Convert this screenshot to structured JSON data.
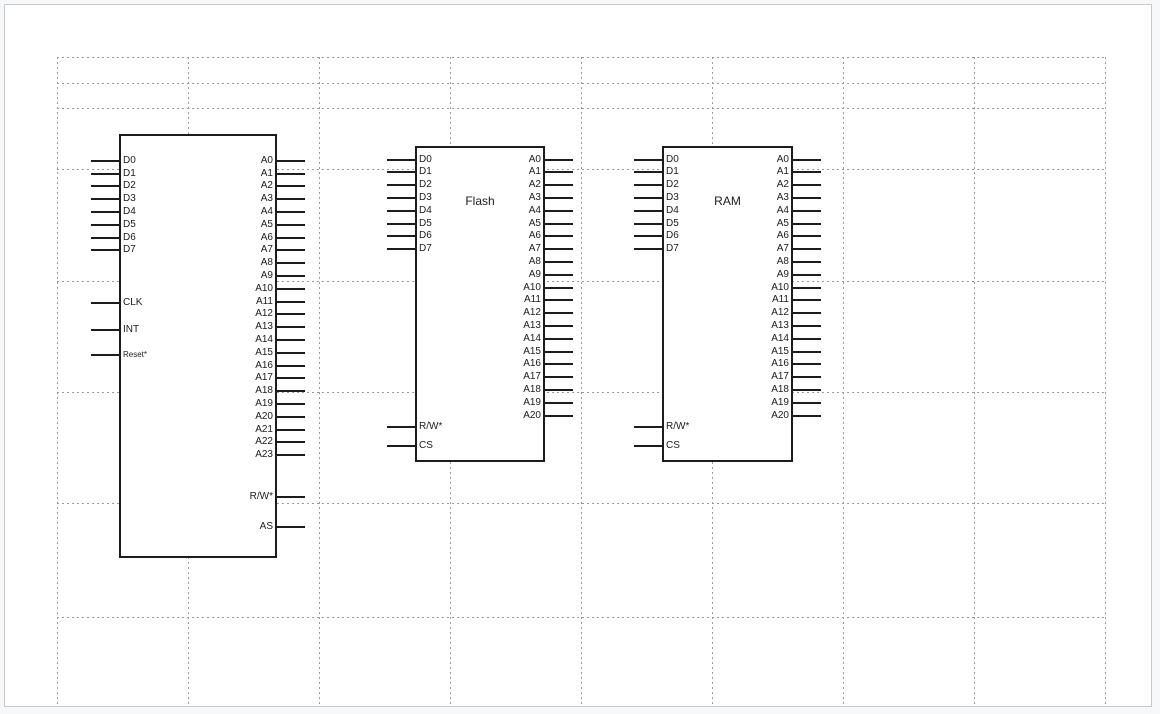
{
  "canvas": {
    "background": "#ffffff",
    "page_border_color": "#c9c9c9",
    "grid_color": "#9b9b9b",
    "line_color": "#1c1c1c"
  },
  "chips": [
    {
      "id": "cpu",
      "title": "",
      "left_pins": [
        {
          "label": "D0",
          "slot": 0
        },
        {
          "label": "D1",
          "slot": 1
        },
        {
          "label": "D2",
          "slot": 2
        },
        {
          "label": "D3",
          "slot": 3
        },
        {
          "label": "D4",
          "slot": 4
        },
        {
          "label": "D5",
          "slot": 5
        },
        {
          "label": "D6",
          "slot": 6
        },
        {
          "label": "D7",
          "slot": 7
        },
        {
          "label": "CLK",
          "slot": 11.15
        },
        {
          "label": "INT",
          "slot": 13.2
        },
        {
          "label": "Reset*",
          "slot": 15.2,
          "small": true
        }
      ],
      "right_pins": [
        {
          "label": "A0",
          "slot": 0
        },
        {
          "label": "A1",
          "slot": 1
        },
        {
          "label": "A2",
          "slot": 2
        },
        {
          "label": "A3",
          "slot": 3
        },
        {
          "label": "A4",
          "slot": 4
        },
        {
          "label": "A5",
          "slot": 5
        },
        {
          "label": "A6",
          "slot": 6
        },
        {
          "label": "A7",
          "slot": 7
        },
        {
          "label": "A8",
          "slot": 8
        },
        {
          "label": "A9",
          "slot": 9
        },
        {
          "label": "A10",
          "slot": 10
        },
        {
          "label": "A11",
          "slot": 11
        },
        {
          "label": "A12",
          "slot": 12
        },
        {
          "label": "A13",
          "slot": 13
        },
        {
          "label": "A14",
          "slot": 14
        },
        {
          "label": "A15",
          "slot": 15
        },
        {
          "label": "A16",
          "slot": 16
        },
        {
          "label": "A17",
          "slot": 17
        },
        {
          "label": "A18",
          "slot": 18
        },
        {
          "label": "A19",
          "slot": 19
        },
        {
          "label": "A20",
          "slot": 20
        },
        {
          "label": "A21",
          "slot": 21
        },
        {
          "label": "A22",
          "slot": 22
        },
        {
          "label": "A23",
          "slot": 23
        },
        {
          "label": "R/W*",
          "slot": 26.25
        },
        {
          "label": "AS",
          "slot": 28.6
        }
      ]
    },
    {
      "id": "flash",
      "title": "Flash",
      "left_pins": [
        {
          "label": "D0",
          "slot": 0
        },
        {
          "label": "D1",
          "slot": 1
        },
        {
          "label": "D2",
          "slot": 2
        },
        {
          "label": "D3",
          "slot": 3
        },
        {
          "label": "D4",
          "slot": 4
        },
        {
          "label": "D5",
          "slot": 5
        },
        {
          "label": "D6",
          "slot": 6
        },
        {
          "label": "D7",
          "slot": 7
        },
        {
          "label": "R/W*",
          "slot": 20.9
        },
        {
          "label": "CS",
          "slot": 22.4
        }
      ],
      "right_pins": [
        {
          "label": "A0",
          "slot": 0
        },
        {
          "label": "A1",
          "slot": 1
        },
        {
          "label": "A2",
          "slot": 2
        },
        {
          "label": "A3",
          "slot": 3
        },
        {
          "label": "A4",
          "slot": 4
        },
        {
          "label": "A5",
          "slot": 5
        },
        {
          "label": "A6",
          "slot": 6
        },
        {
          "label": "A7",
          "slot": 7
        },
        {
          "label": "A8",
          "slot": 8
        },
        {
          "label": "A9",
          "slot": 9
        },
        {
          "label": "A10",
          "slot": 10
        },
        {
          "label": "A11",
          "slot": 11
        },
        {
          "label": "A12",
          "slot": 12
        },
        {
          "label": "A13",
          "slot": 13
        },
        {
          "label": "A14",
          "slot": 14
        },
        {
          "label": "A15",
          "slot": 15
        },
        {
          "label": "A16",
          "slot": 16
        },
        {
          "label": "A17",
          "slot": 17
        },
        {
          "label": "A18",
          "slot": 18
        },
        {
          "label": "A19",
          "slot": 19
        },
        {
          "label": "A20",
          "slot": 20
        }
      ]
    },
    {
      "id": "ram",
      "title": "RAM",
      "left_pins": [
        {
          "label": "D0",
          "slot": 0
        },
        {
          "label": "D1",
          "slot": 1
        },
        {
          "label": "D2",
          "slot": 2
        },
        {
          "label": "D3",
          "slot": 3
        },
        {
          "label": "D4",
          "slot": 4
        },
        {
          "label": "D5",
          "slot": 5
        },
        {
          "label": "D6",
          "slot": 6
        },
        {
          "label": "D7",
          "slot": 7
        },
        {
          "label": "R/W*",
          "slot": 20.9
        },
        {
          "label": "CS",
          "slot": 22.4
        }
      ],
      "right_pins": [
        {
          "label": "A0",
          "slot": 0
        },
        {
          "label": "A1",
          "slot": 1
        },
        {
          "label": "A2",
          "slot": 2
        },
        {
          "label": "A3",
          "slot": 3
        },
        {
          "label": "A4",
          "slot": 4
        },
        {
          "label": "A5",
          "slot": 5
        },
        {
          "label": "A6",
          "slot": 6
        },
        {
          "label": "A7",
          "slot": 7
        },
        {
          "label": "A8",
          "slot": 8
        },
        {
          "label": "A9",
          "slot": 9
        },
        {
          "label": "A10",
          "slot": 10
        },
        {
          "label": "A11",
          "slot": 11
        },
        {
          "label": "A12",
          "slot": 12
        },
        {
          "label": "A13",
          "slot": 13
        },
        {
          "label": "A14",
          "slot": 14
        },
        {
          "label": "A15",
          "slot": 15
        },
        {
          "label": "A16",
          "slot": 16
        },
        {
          "label": "A17",
          "slot": 17
        },
        {
          "label": "A18",
          "slot": 18
        },
        {
          "label": "A19",
          "slot": 19
        },
        {
          "label": "A20",
          "slot": 20
        }
      ]
    }
  ]
}
